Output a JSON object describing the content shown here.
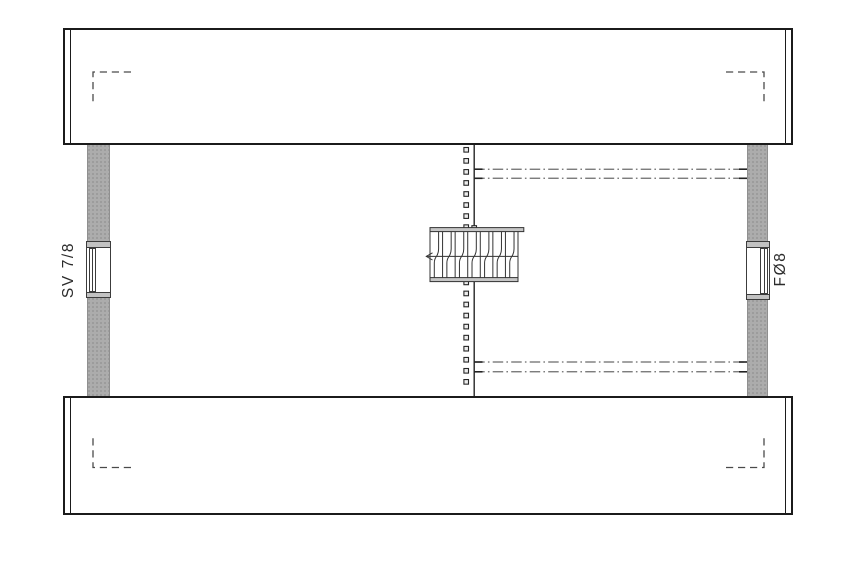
{
  "plan": {
    "drawing_kind": "attic floor plan",
    "windows": [
      {
        "id": "left",
        "label": "SV 7/8"
      },
      {
        "id": "right",
        "label": "FØ8"
      }
    ],
    "colors": {
      "background": "#ffffff",
      "outline": "#1b1b1b",
      "wall_fill": "#acacac",
      "window_frame": "#3c3c3c",
      "centerline": "#262626",
      "dot_fill": "#ededed",
      "dashdot": "#6b6b6b",
      "tick_dark": "#222222",
      "dashed_mark": "#4a4a4a",
      "stair_line": "#333333",
      "stair_rail_fill": "#c6c6c6",
      "label_color": "#2b2b2b"
    }
  }
}
